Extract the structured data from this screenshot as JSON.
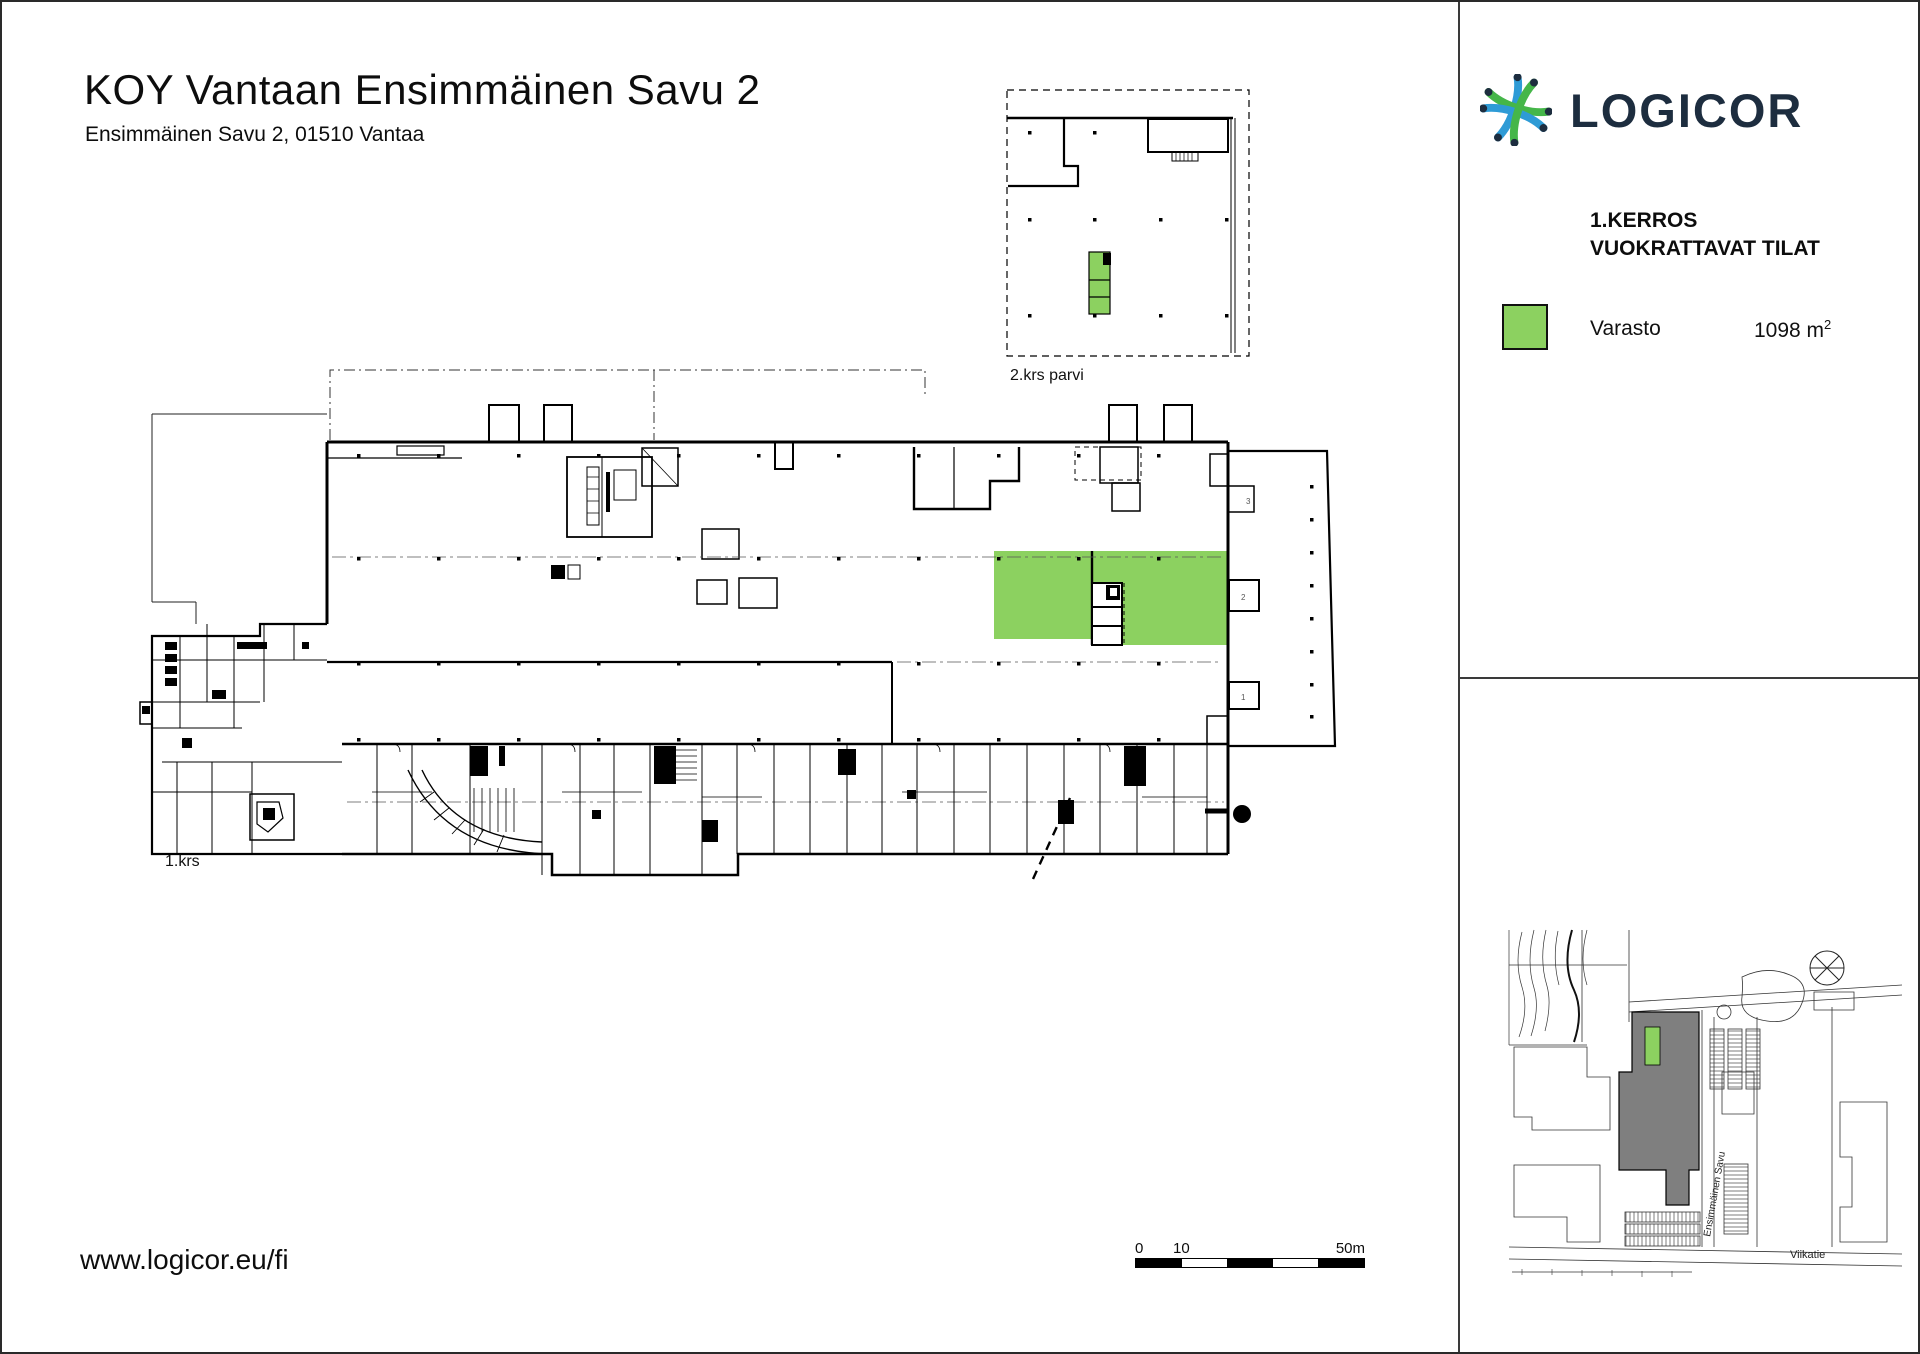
{
  "page": {
    "title": "KOY Vantaan Ensimmäinen Savu 2",
    "subtitle": "Ensimmäinen Savu 2, 01510 Vantaa",
    "url": "www.logicor.eu/fi"
  },
  "plan": {
    "floor_label": "1.krs",
    "inset_label": "2.krs parvi",
    "annex_rooms": {
      "r3": "3",
      "r2": "2",
      "r1": "1"
    }
  },
  "scalebar": {
    "start": "0",
    "mid": "10",
    "end": "50m"
  },
  "sidebar": {
    "brand": "LOGICOR",
    "heading1": "1.KERROS",
    "heading2": "VUOKRATTAVAT TILAT",
    "legend_label": "Varasto",
    "legend_area": "1098 m",
    "legend_area_sup": "2"
  },
  "map": {
    "street1": "Viikatie",
    "street2": "Ensimmäinen Savu"
  },
  "colors": {
    "highlight": "#8CD160",
    "building": "#7F7F7F",
    "logo_navy": "#1D2D3F",
    "logo_green": "#45B649",
    "logo_blue": "#2E9BD6"
  }
}
